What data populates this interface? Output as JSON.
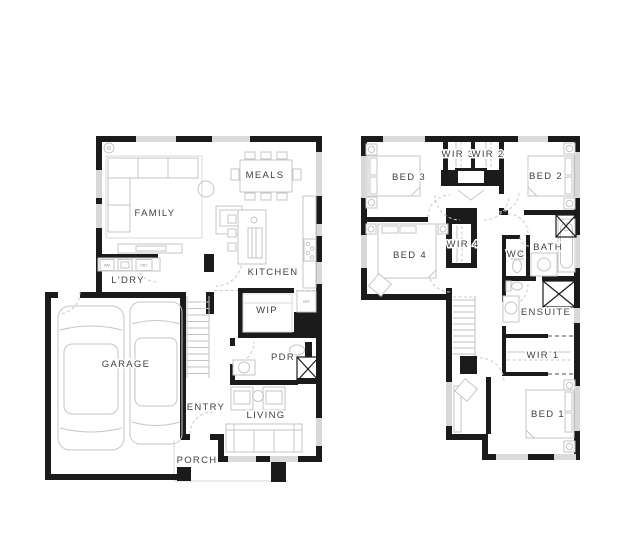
{
  "colors": {
    "wall": "#1b1b1b",
    "furniture": "#c6c6c6",
    "label": "#404040",
    "background": "#ffffff"
  },
  "ground_floor": {
    "rooms": {
      "family": "FAMILY",
      "meals": "MEALS",
      "kitchen": "KITCHEN",
      "laundry": "L'DRY",
      "wip": "WIP",
      "pdr": "PDR",
      "garage": "GARAGE",
      "entry": "ENTRY",
      "living": "LIVING",
      "porch": "PORCH"
    },
    "appliances": {
      "washer": "WM",
      "dryer": "DRY",
      "fridge": "REF"
    }
  },
  "upper_floor": {
    "rooms": {
      "bed3": "BED 3",
      "wir3": "WIR 3",
      "wir2": "WIR 2",
      "bed2": "BED 2",
      "bed4": "BED 4",
      "wir4": "WIR 4",
      "wc": "WC",
      "bath": "BATH",
      "ensuite": "ENSUITE",
      "wir1": "WIR 1",
      "bed1": "BED 1"
    }
  }
}
